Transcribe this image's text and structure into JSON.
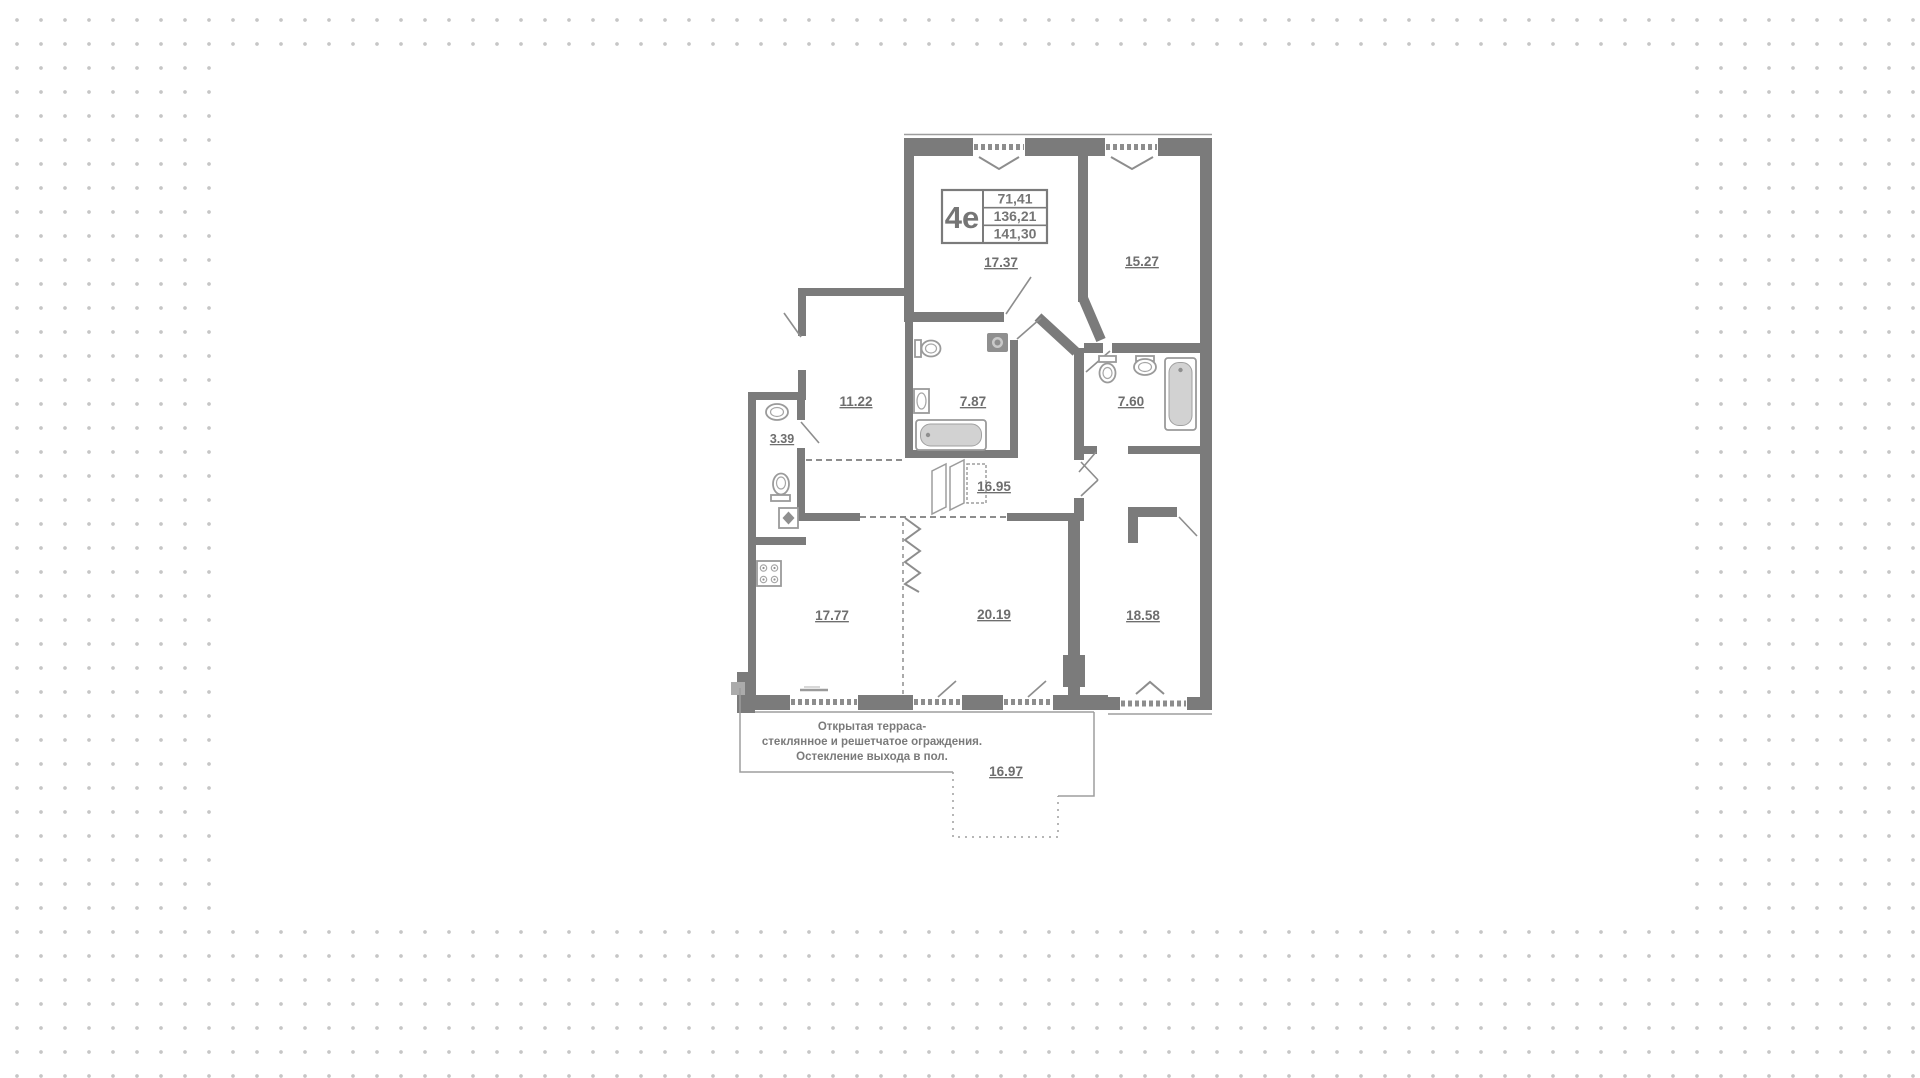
{
  "plan": {
    "title_block": {
      "unit": "4е",
      "values": [
        "71,41",
        "136,21",
        "141,30"
      ]
    },
    "rooms": [
      {
        "area": "17.37"
      },
      {
        "area": "15.27"
      },
      {
        "area": "11.22"
      },
      {
        "area": "7.87"
      },
      {
        "area": "7.60"
      },
      {
        "area": "3.39"
      },
      {
        "area": "16.95"
      },
      {
        "area": "17.77"
      },
      {
        "area": "20.19"
      },
      {
        "area": "18.58"
      }
    ],
    "terrace": {
      "area": "16.97",
      "note_lines": [
        "Открытая терраса-",
        "стеклянное и решетчатое ограждения.",
        "Остекление выхода в пол."
      ]
    },
    "colors": {
      "wall": "#7b7b7b",
      "background_dot": "#c6c6c6",
      "label_text": "#6e6e6e"
    }
  }
}
